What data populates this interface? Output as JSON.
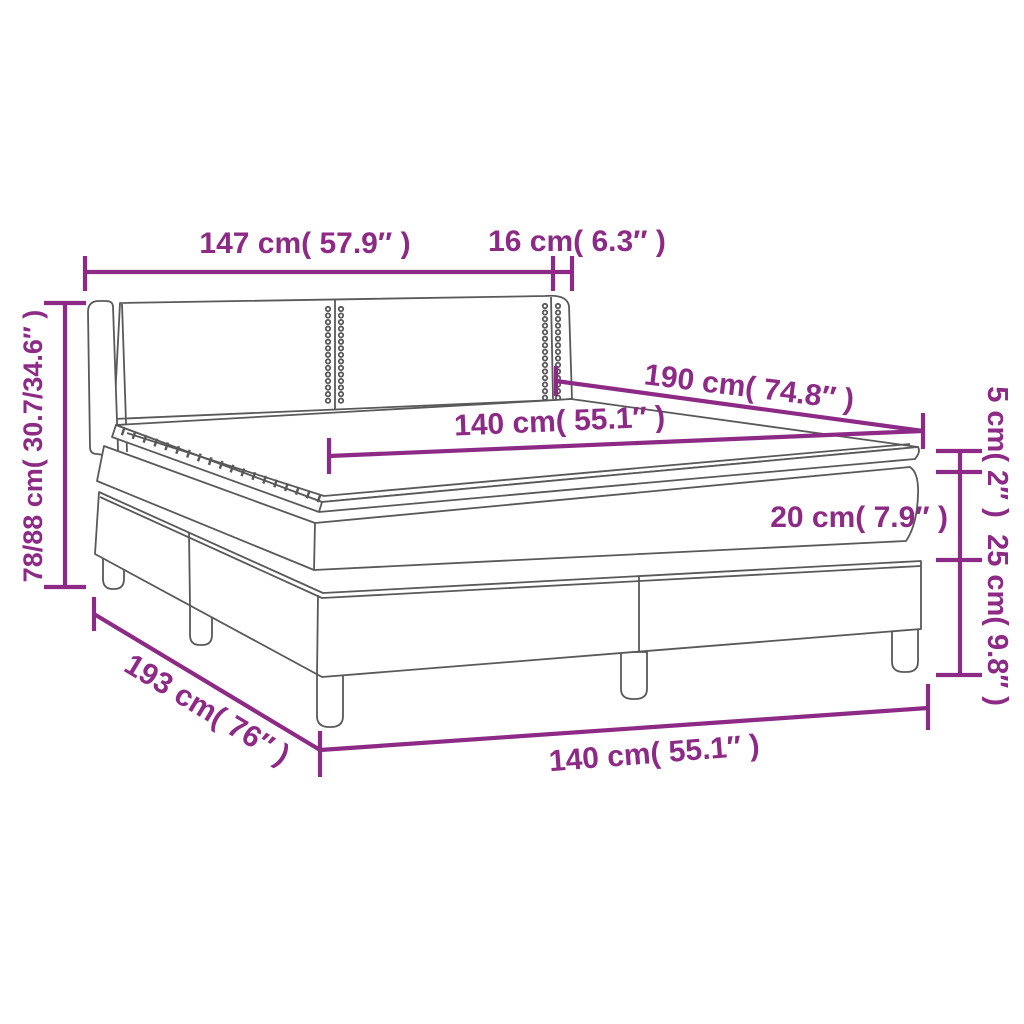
{
  "diagram": {
    "kind": "product-dimension-diagram",
    "product": "box spring bed with headboard, mattress and topper",
    "accent_color": "#8c2a86",
    "line_color": "#595959",
    "background_color": "#ffffff"
  },
  "dimensions": {
    "headboard_width": {
      "label": "147 cm( 57.9″ )",
      "value_cm": "147",
      "value_in": "57.9"
    },
    "wing_depth": {
      "label": "16 cm( 6.3″ )",
      "value_cm": "16",
      "value_in": "6.3"
    },
    "total_height": {
      "label": "78/88 cm( 30.7/34.6″ )",
      "value_cm": "78/88",
      "value_in": "30.7/34.6"
    },
    "bed_length": {
      "label": "190 cm( 74.8″ )",
      "value_cm": "190",
      "value_in": "74.8"
    },
    "mattress_width": {
      "label": "140 cm( 55.1″ )",
      "value_cm": "140",
      "value_in": "55.1"
    },
    "topper_height": {
      "label": "5 cm( 2″ )",
      "value_cm": "5",
      "value_in": "2"
    },
    "mattress_height": {
      "label": "20 cm( 7.9″ )",
      "value_cm": "20",
      "value_in": "7.9"
    },
    "base_height": {
      "label": "25 cm( 9.8″ )",
      "value_cm": "25",
      "value_in": "9.8"
    },
    "frame_length": {
      "label": "193 cm( 76″ )",
      "value_cm": "193",
      "value_in": "76"
    },
    "frame_width": {
      "label": "140 cm( 55.1″ )",
      "value_cm": "140",
      "value_in": "55.1"
    }
  }
}
